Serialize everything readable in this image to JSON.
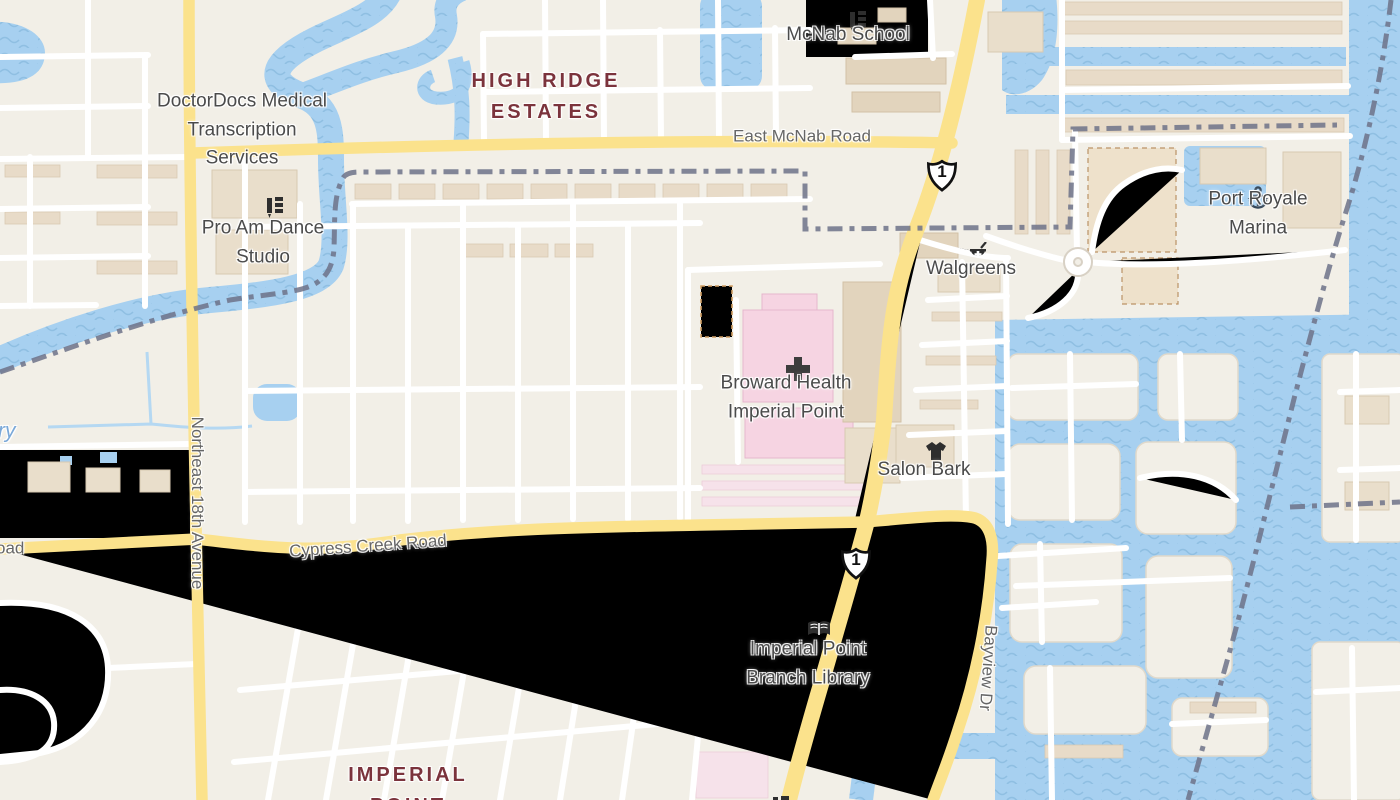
{
  "app": {
    "type": "map-viewer",
    "description": "street map tile view"
  },
  "map": {
    "colors": {
      "land": "#f2efe7",
      "water": "#a7d0f0",
      "water_wave": "#8fbfe2",
      "road_major_fill": "#fbe28c",
      "road_major_casing": "#e29a60",
      "road_minor_fill": "#ffffff",
      "road_minor_casing": "#d8d1c5",
      "boundary": "#6d7288",
      "neighborhood_text": "#7b333c",
      "poi_text": "#4b4b4b",
      "road_text": "#666666",
      "water_text": "#7aa8d8"
    },
    "labels": {
      "mcnab_school": "McNab School",
      "high_ridge_estates": "HIGH RIDGE\nESTATES",
      "doctordocs": "DoctorDocs Medical\nTranscription\nServices",
      "pro_am": "Pro Am Dance\nStudio",
      "east_mcnab_road": "East McNab Road",
      "port_royale_marina": "Port Royale Marina",
      "walgreens": "Walgreens",
      "broward_health": "Broward Health\nImperial Point",
      "salon_bark": "Salon Bark",
      "cypress_creek_road": "Cypress Creek Road",
      "cypress_creek_road_partial": "oad",
      "water_name_partial": "ry",
      "northeast_18th_avenue": "Northeast 18th Avenue",
      "bayview_drive": "Bayview Dr",
      "imperial_point_library": "Imperial Point\nBranch Library",
      "imperial_point": "IMPERIAL\nPOINT",
      "route_1_shield": "1"
    },
    "icons": [
      {
        "name": "school-icon",
        "for": "McNab School"
      },
      {
        "name": "dance-studio-icon",
        "for": "Pro Am Dance Studio"
      },
      {
        "name": "pharmacy-icon",
        "for": "Walgreens"
      },
      {
        "name": "hospital-cross-icon",
        "for": "Broward Health Imperial Point"
      },
      {
        "name": "clothing-shop-icon",
        "for": "Salon Bark"
      },
      {
        "name": "anchor-icon",
        "for": "Port Royale Marina"
      },
      {
        "name": "library-book-icon",
        "for": "Imperial Point Branch Library"
      },
      {
        "name": "school-icon",
        "for": "partially visible place at bottom edge"
      }
    ]
  }
}
